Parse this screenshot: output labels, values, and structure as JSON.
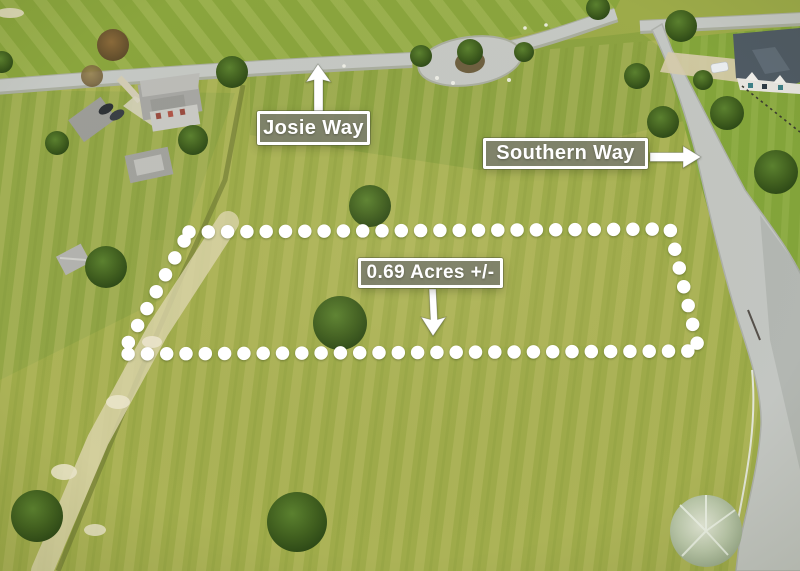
{
  "labels": {
    "josie_way": {
      "text": "Josie Way"
    },
    "southern_way": {
      "text": "Southern Way"
    },
    "acreage": {
      "text": "0.69 Acres +/-"
    }
  },
  "colors": {
    "annotation_white": "#ffffff",
    "label_box_fill": "#7d7f6c",
    "label_border": "#ffffff",
    "grass_base": "#9dab49",
    "road_gray": "#c3c6c2"
  }
}
